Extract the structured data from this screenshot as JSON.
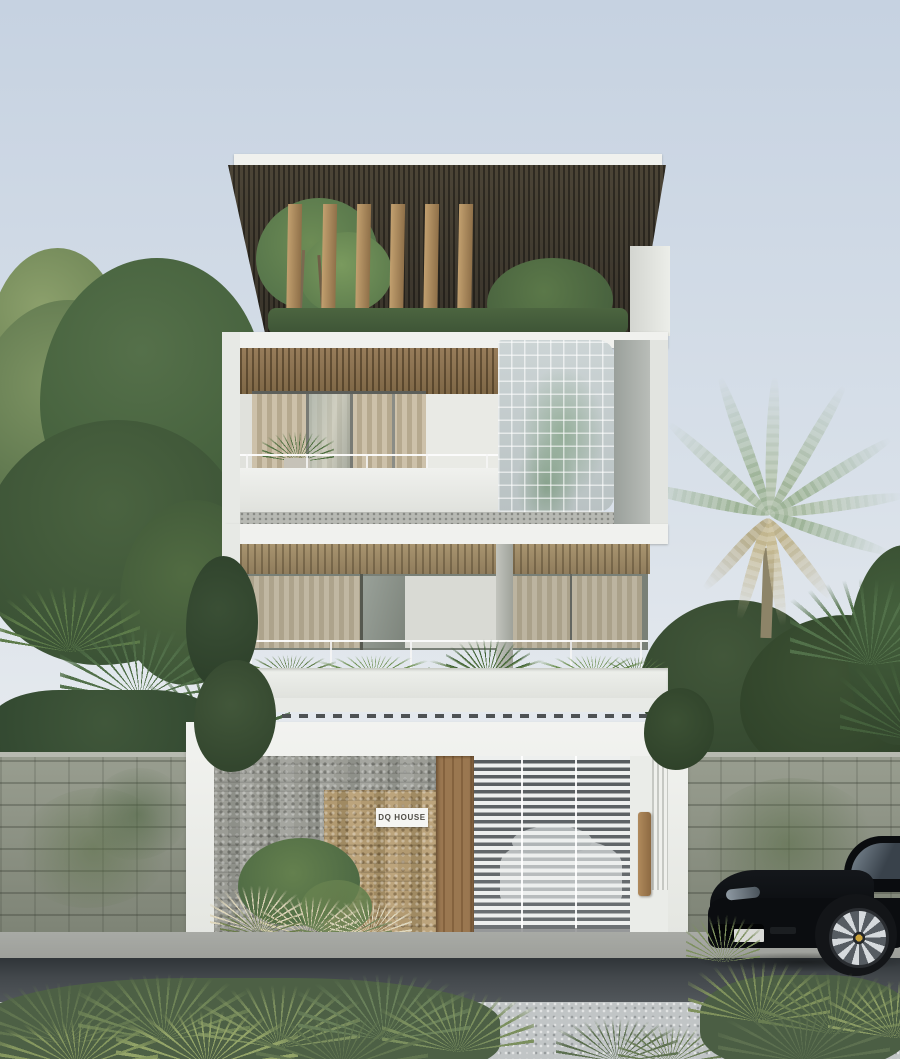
{
  "signage": {
    "house_sign": "DQ HOUSE"
  },
  "palette": {
    "sky-top": "#c6d2e1",
    "sky-mid": "#d8e0e9",
    "sky-low": "#eaedf0",
    "white-wall": "#f0f1ee",
    "soffit": "#38332a",
    "ceiling-wood": "#977c5a",
    "ceiling-wood-2": "#a8946f",
    "louver": "#c2a06f",
    "curtain-a": "#cdc1aa",
    "curtain-b": "#b6a98f",
    "glass-block": "#ccd4d5",
    "stone-grey": "#9b9c95",
    "stone-tan": "#b29a71",
    "wood-door": "#9a7750",
    "garage-slat": "#edefee",
    "boundary-wall": "#999e90",
    "road": "#42474b",
    "pavement": "#c1c5c6",
    "sidewalk": "#a8aaa5",
    "leaf-dark": "#3c5336",
    "leaf-mid": "#52704a",
    "leaf-light": "#8ca06c",
    "palm-green": "#a3b69c",
    "palm-dry": "#c7bb94",
    "plume": "#ddd5ba",
    "shrub-base": "#4d6045",
    "car-body": "#0b0d10",
    "car-glass": "#7d8a95",
    "rim": "#d6dadd",
    "sign-bg": "#f5f5f3",
    "sign-text": "#4f4c45"
  }
}
